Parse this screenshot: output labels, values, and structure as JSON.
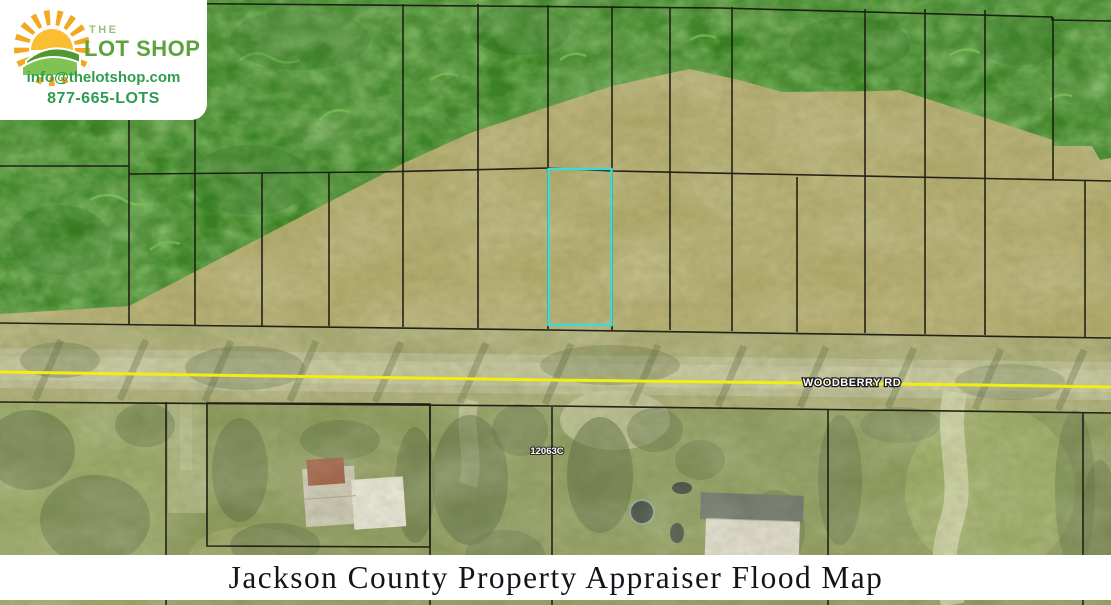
{
  "branding": {
    "prefix": "THE",
    "name": "LOT SHOP",
    "email": "info@thelotshop.com",
    "phone": "877-665-LOTS"
  },
  "map": {
    "road_label": "WOODBERRY RD",
    "parcel_label": "12063C"
  },
  "footer": {
    "title": "Jackson County Property Appraiser Flood Map"
  },
  "colors": {
    "flood_zone_green": "#35811f",
    "parcel_highlight_cyan": "#3adcd6",
    "road_centerline_yellow": "#f2ee13",
    "brand_green": "#2f9e4b"
  }
}
